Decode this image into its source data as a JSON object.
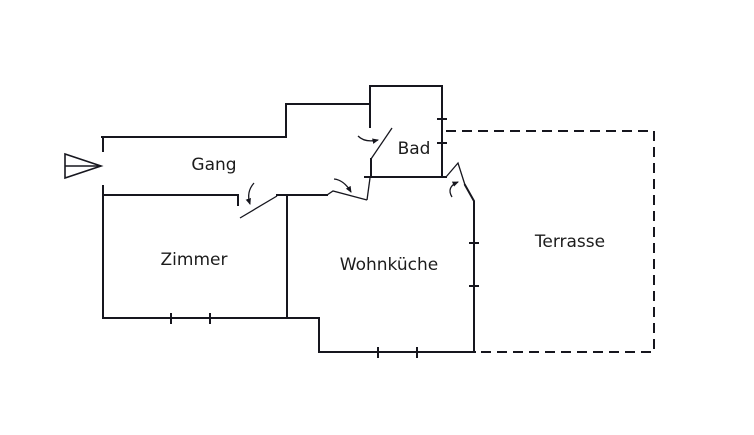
{
  "diagram": {
    "type": "floor-plan",
    "rooms": {
      "gang": "Gang",
      "bad": "Bad",
      "zimmer": "Zimmer",
      "wohnkueche": "Wohnküche",
      "terrasse": "Terrasse"
    },
    "colors": {
      "background": "#ffffff",
      "line": "#16161e",
      "text": "#1c1c1c"
    }
  }
}
